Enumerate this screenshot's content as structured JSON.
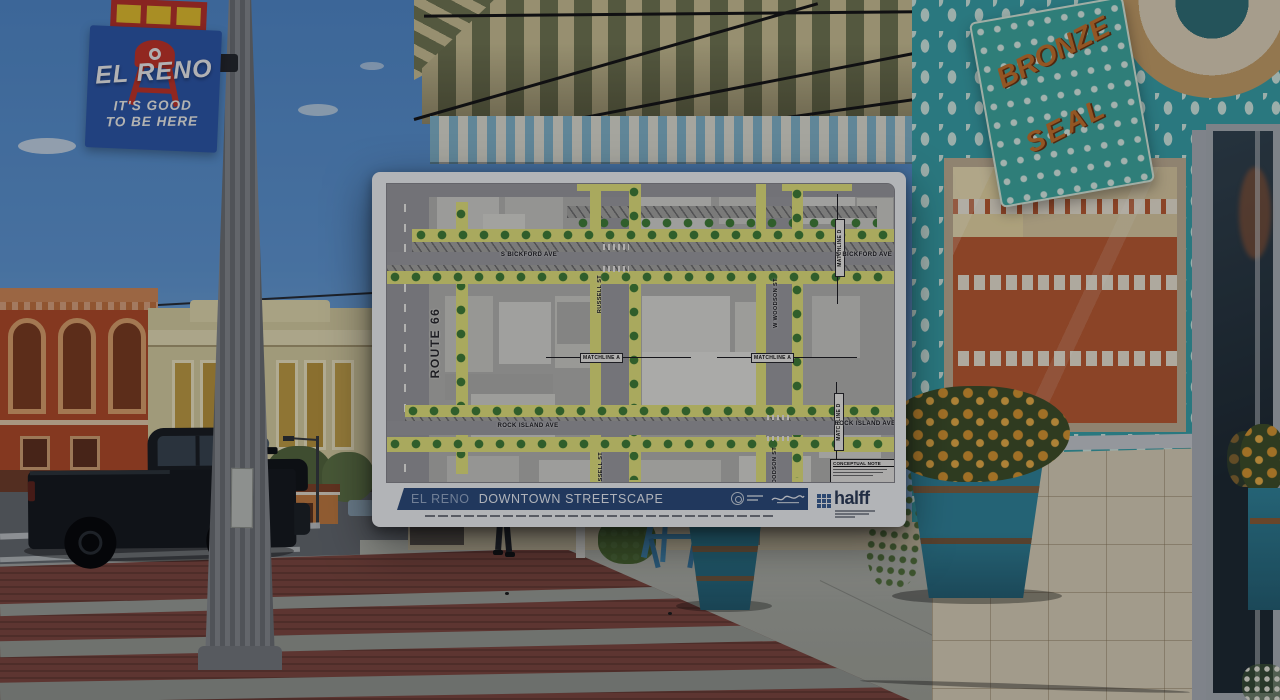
{
  "photo": {
    "banner": {
      "title": "EL RENO",
      "tagline1": "IT'S GOOD",
      "tagline2": "TO BE HERE"
    },
    "bronze_sign": {
      "word1": "BRONZE",
      "word2": "SEAL"
    },
    "colors": {
      "sky": "#5590cc",
      "storefront_teal": "#379fa6",
      "planter_teal": "#2f8399",
      "mums_orange": "#d6952f",
      "brick_red": "#7b463d"
    }
  },
  "plan": {
    "title": {
      "prefix": "EL RENO",
      "main": "DOWNTOWN STREETSCAPE"
    },
    "logo": {
      "name": "halff"
    },
    "note": {
      "title": "CONCEPTUAL NOTE"
    },
    "streets": {
      "route66": "ROUTE 66",
      "bickford_left": "S BICKFORD AVE",
      "bickford_right": "S BICKFORD AVE",
      "russell_upper": "RUSSELL ST",
      "russell_lower": "RUSSELL ST",
      "woodson_mid": "W WOODSON ST",
      "woodson_lower": "WOODSON ST",
      "rock_island_left": "ROCK ISLAND AVE",
      "rock_island_right": "ROCK ISLAND AVE",
      "matchline_a_left": "MATCHLINE A",
      "matchline_a_right": "MATCHLINE A",
      "matchline_d_upper": "MATCHLINE D",
      "matchline_d_lower": "MATCHLINE D"
    },
    "colors": {
      "title_bar_navy": "#2a4a78",
      "highlight_yellow": "#e2e27a",
      "tree_green": "#3e7d35",
      "brand_blue": "#3a5f92"
    }
  }
}
